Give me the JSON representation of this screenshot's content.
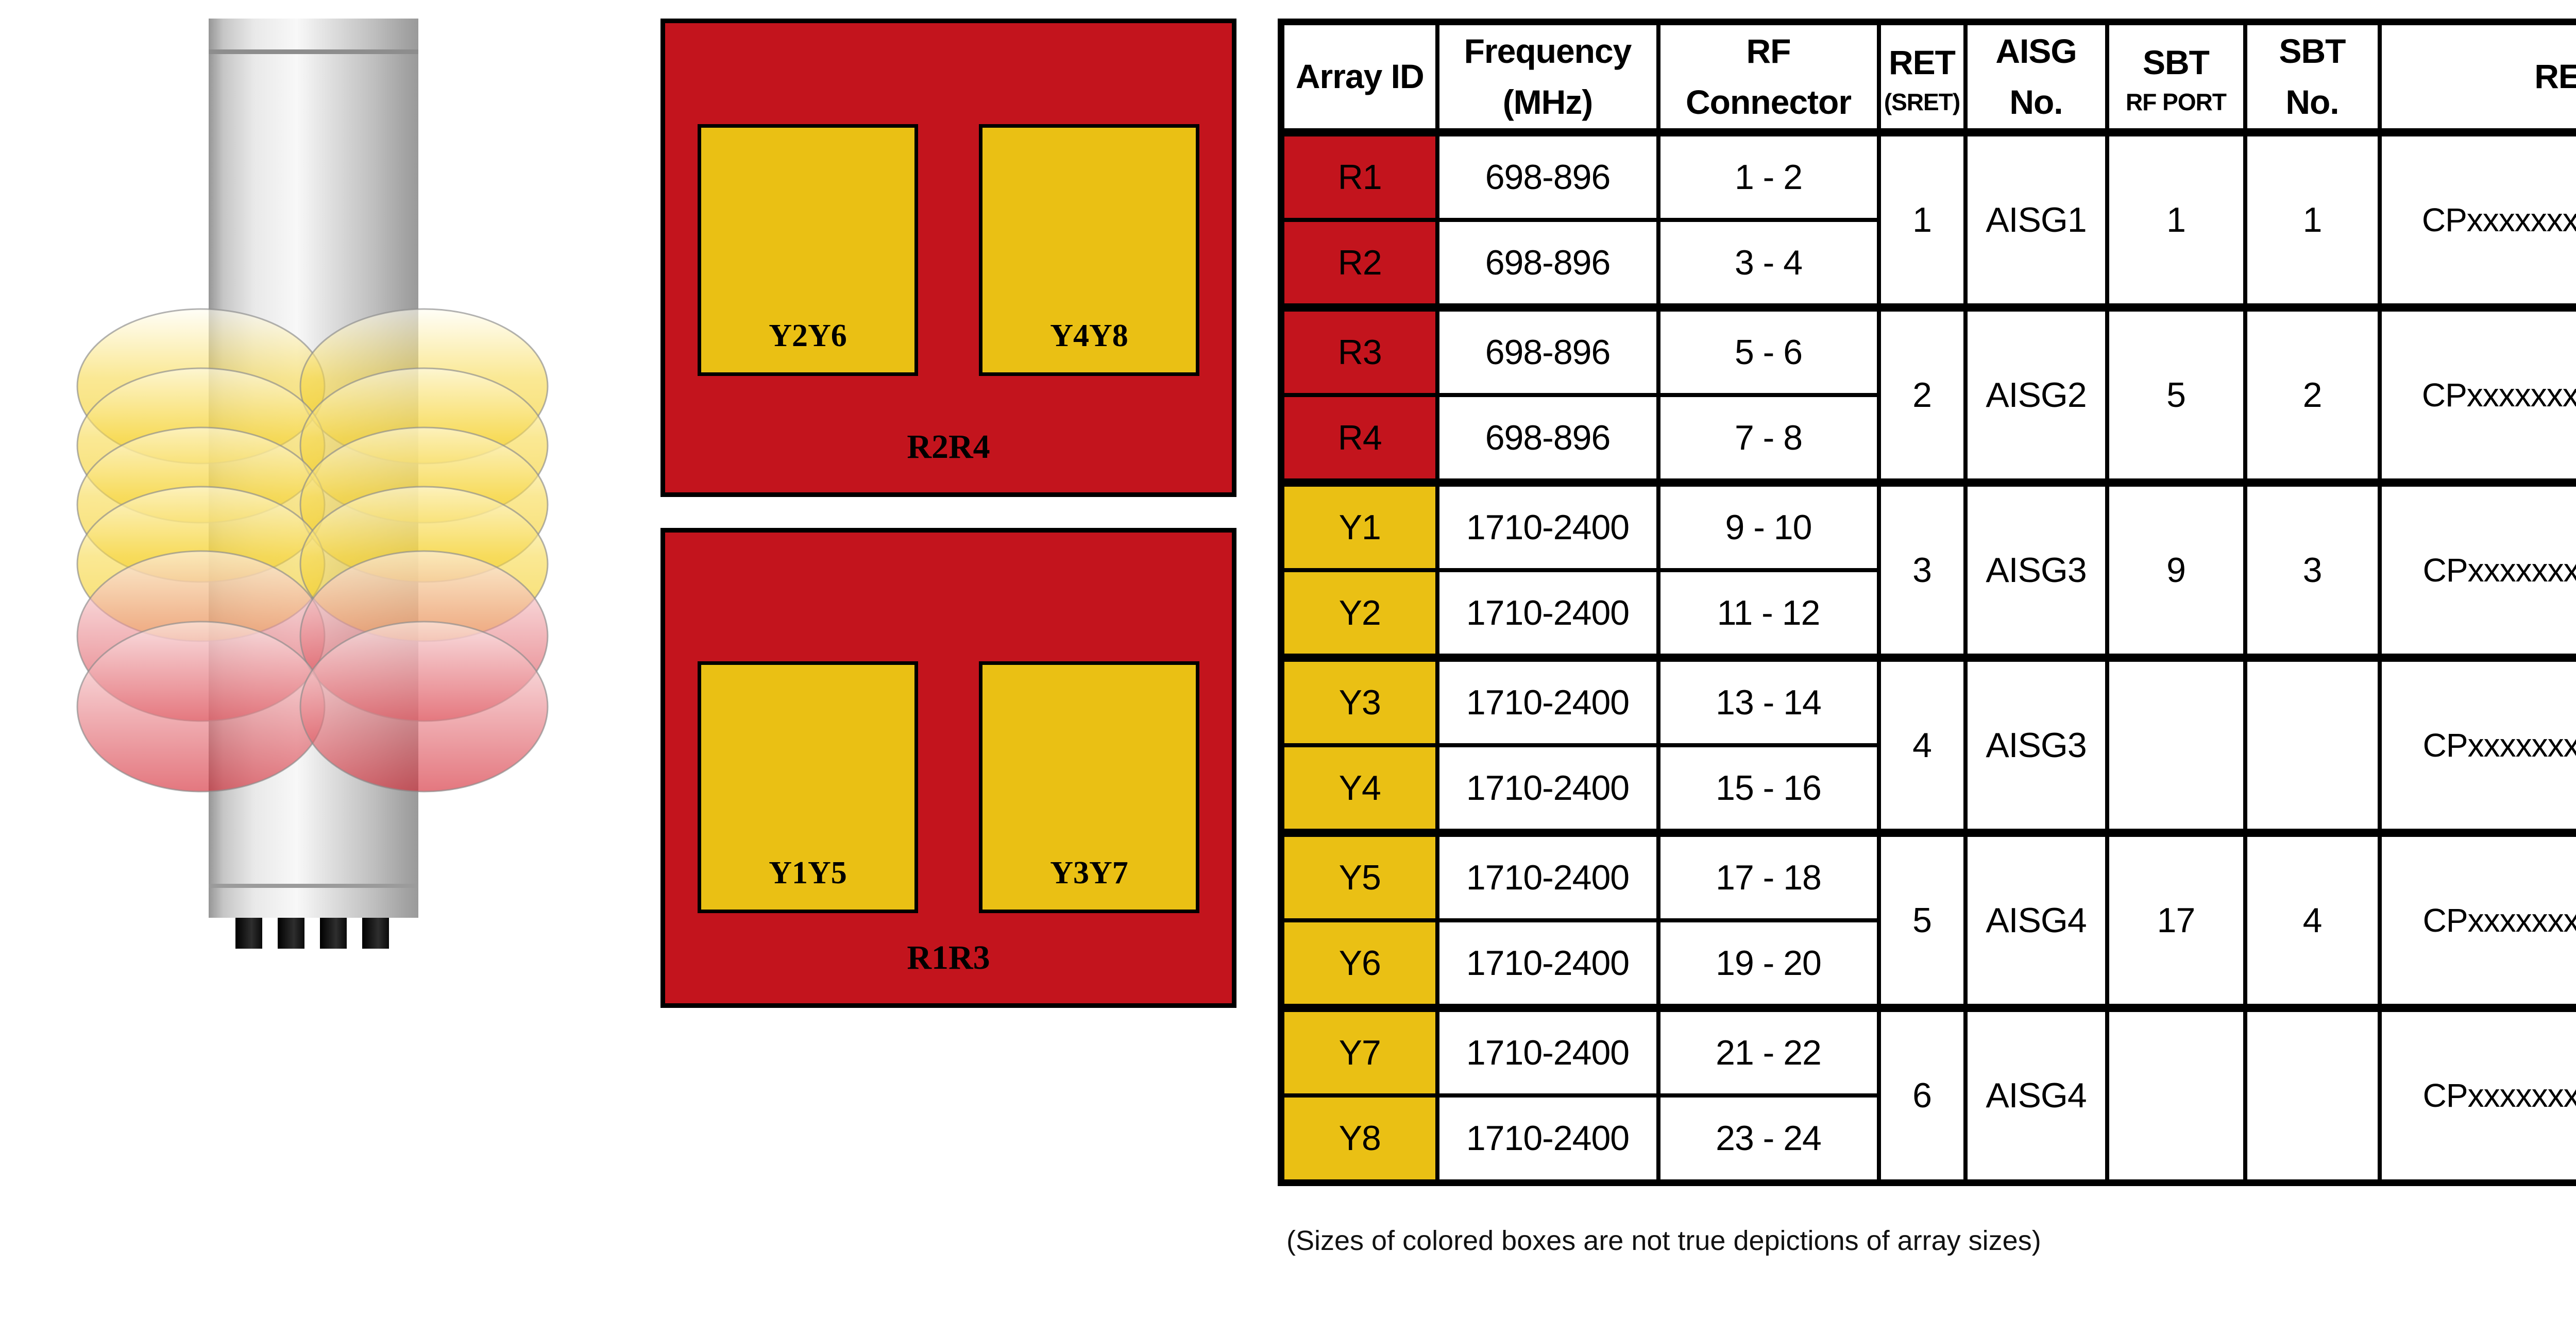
{
  "array_layout": {
    "top_box": {
      "label": "R2R4",
      "left_array": "Y2Y6",
      "right_array": "Y4Y8"
    },
    "bottom_box": {
      "label": "R1R3",
      "left_array": "Y1Y5",
      "right_array": "Y3Y7"
    }
  },
  "table": {
    "headers": {
      "array_id": "Array ID",
      "frequency_line1": "Frequency",
      "frequency_line2": "(MHz)",
      "rf_line1": "RF",
      "rf_line2": "Connector",
      "ret_line1": "RET",
      "ret_line2": "(SRET)",
      "aisg_line1": "AISG",
      "aisg_line2": "No.",
      "sbt_port_line1": "SBT",
      "sbt_port_line2": "RF PORT",
      "sbt_no_line1": "SBT",
      "sbt_no_line2": "No.",
      "ret_uid": "RET UID"
    },
    "rows": [
      {
        "array_id": "R1",
        "frequency": "698-896",
        "rf_connector": "1 - 2",
        "color": "#C3141D"
      },
      {
        "array_id": "R2",
        "frequency": "698-896",
        "rf_connector": "3 - 4",
        "color": "#C3141D"
      },
      {
        "array_id": "R3",
        "frequency": "698-896",
        "rf_connector": "5 - 6",
        "color": "#C3141D"
      },
      {
        "array_id": "R4",
        "frequency": "698-896",
        "rf_connector": "7 - 8",
        "color": "#C3141D"
      },
      {
        "array_id": "Y1",
        "frequency": "1710-2400",
        "rf_connector": "9 - 10",
        "color": "#EAC014"
      },
      {
        "array_id": "Y2",
        "frequency": "1710-2400",
        "rf_connector": "11 - 12",
        "color": "#EAC014"
      },
      {
        "array_id": "Y3",
        "frequency": "1710-2400",
        "rf_connector": "13 - 14",
        "color": "#EAC014"
      },
      {
        "array_id": "Y4",
        "frequency": "1710-2400",
        "rf_connector": "15 - 16",
        "color": "#EAC014"
      },
      {
        "array_id": "Y5",
        "frequency": "1710-2400",
        "rf_connector": "17 - 18",
        "color": "#EAC014"
      },
      {
        "array_id": "Y6",
        "frequency": "1710-2400",
        "rf_connector": "19 - 20",
        "color": "#EAC014"
      },
      {
        "array_id": "Y7",
        "frequency": "1710-2400",
        "rf_connector": "21 - 22",
        "color": "#EAC014"
      },
      {
        "array_id": "Y8",
        "frequency": "1710-2400",
        "rf_connector": "23 - 24",
        "color": "#EAC014"
      }
    ],
    "groups": [
      {
        "ret": "1",
        "aisg": "AISG1",
        "sbt_rf_port": "1",
        "sbt_no": "1",
        "ret_uid": "CPxxxxxxxxxxxxxxxxxR1"
      },
      {
        "ret": "2",
        "aisg": "AISG2",
        "sbt_rf_port": "5",
        "sbt_no": "2",
        "ret_uid": "CPxxxxxxxxxxxxxxxxxR3"
      },
      {
        "ret": "3",
        "aisg": "AISG3",
        "sbt_rf_port": "9",
        "sbt_no": "3",
        "ret_uid": "CPxxxxxxxxxxxxxxxxxY1"
      },
      {
        "ret": "4",
        "aisg": "AISG3",
        "sbt_rf_port": "",
        "sbt_no": "",
        "ret_uid": "CPxxxxxxxxxxxxxxxxxY3"
      },
      {
        "ret": "5",
        "aisg": "AISG4",
        "sbt_rf_port": "17",
        "sbt_no": "4",
        "ret_uid": "CPxxxxxxxxxxxxxxxxxY5"
      },
      {
        "ret": "6",
        "aisg": "AISG4",
        "sbt_rf_port": "",
        "sbt_no": "",
        "ret_uid": "CPxxxxxxxxxxxxxxxxxY7"
      }
    ]
  },
  "footnote": "(Sizes of colored boxes are not true depictions of array sizes)",
  "colors": {
    "array_red": "#C3141D",
    "array_yellow": "#EAC014",
    "disc_yellow": "#F0C400",
    "disc_red": "#D32430"
  }
}
